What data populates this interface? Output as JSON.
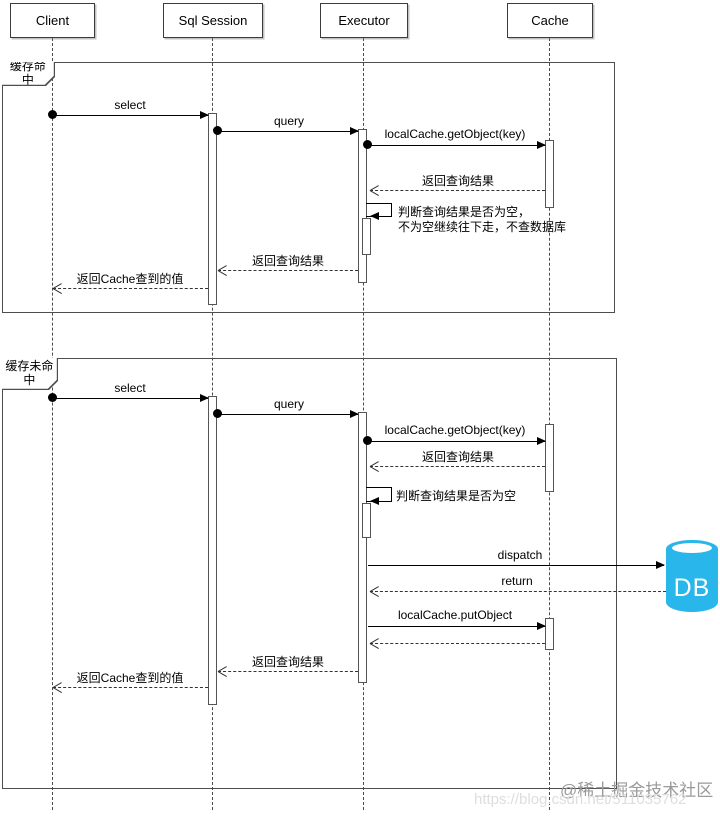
{
  "participants": [
    {
      "label": "Client"
    },
    {
      "label": "Sql Session"
    },
    {
      "label": "Executor"
    },
    {
      "label": "Cache"
    }
  ],
  "frame1": {
    "label": "缓存命中",
    "msg_select": "select",
    "msg_query": "query",
    "msg_get_object": "localCache.getObject(key)",
    "msg_return_result_cache": "返回查询结果",
    "note_line1": "判断查询结果是否为空，",
    "note_line2": "不为空继续往下走，不查数据库",
    "msg_return_result_session": "返回查询结果",
    "msg_return_cache_value": "返回Cache查到的值"
  },
  "frame2": {
    "label": "缓存未命中",
    "msg_select": "select",
    "msg_query": "query",
    "msg_get_object": "localCache.getObject(key)",
    "msg_return_result_cache": "返回查询结果",
    "note": "判断查询结果是否为空",
    "msg_dispatch": "dispatch",
    "msg_return": "return",
    "msg_put_object": "localCache.putObject",
    "msg_return_result_session": "返回查询结果",
    "msg_return_cache_value": "返回Cache查到的值"
  },
  "db": {
    "label": "DB",
    "fill_color": "#29b6ea"
  },
  "watermark": {
    "community": "@稀土掘金技术社区",
    "url": "https://blog.csdn.net/511035762"
  }
}
